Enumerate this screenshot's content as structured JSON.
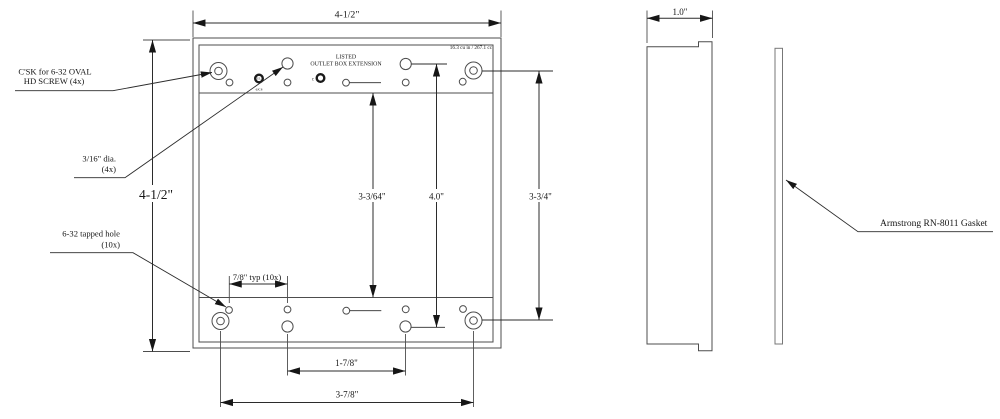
{
  "drawing": {
    "front_view": {
      "width_dim": "4-1/2\"",
      "height_dim": "4-1/2\"",
      "row_spacing_dim": "3-3/64\"",
      "device_hole_spacing_dim": "4.0\"",
      "right_hole_spacing_dim": "3-3/4\"",
      "tapped_hole_pitch_dim": "7/8\" typ (10x)",
      "bottom_inner_span_dim": "1-7/8\"",
      "bottom_outer_span_dim": "3-7/8\"",
      "listing_line1": "LISTED",
      "listing_line2": "OUTLET BOX EXTENSION",
      "volume_note": "16.3 cu in / 267.1 cc",
      "ul_mark_letters": "UL",
      "ul_mark_code": "6JC8",
      "cul_mark_prefix": "c"
    },
    "side_view": {
      "depth_dim": "1.0\""
    },
    "callouts": {
      "csk_line1": "C'SK for 6-32 OVAL",
      "csk_line2": "HD SCREW (4x)",
      "dia_line1": "3/16\" dia.",
      "dia_line2": "(4x)",
      "tapped_line1": "6-32 tapped hole",
      "tapped_line2": "(10x)",
      "gasket_label": "Armstrong RN-8011 Gasket"
    },
    "colors": {
      "line": "#4d4d4d",
      "text": "#161616",
      "background": "#ffffff"
    }
  }
}
